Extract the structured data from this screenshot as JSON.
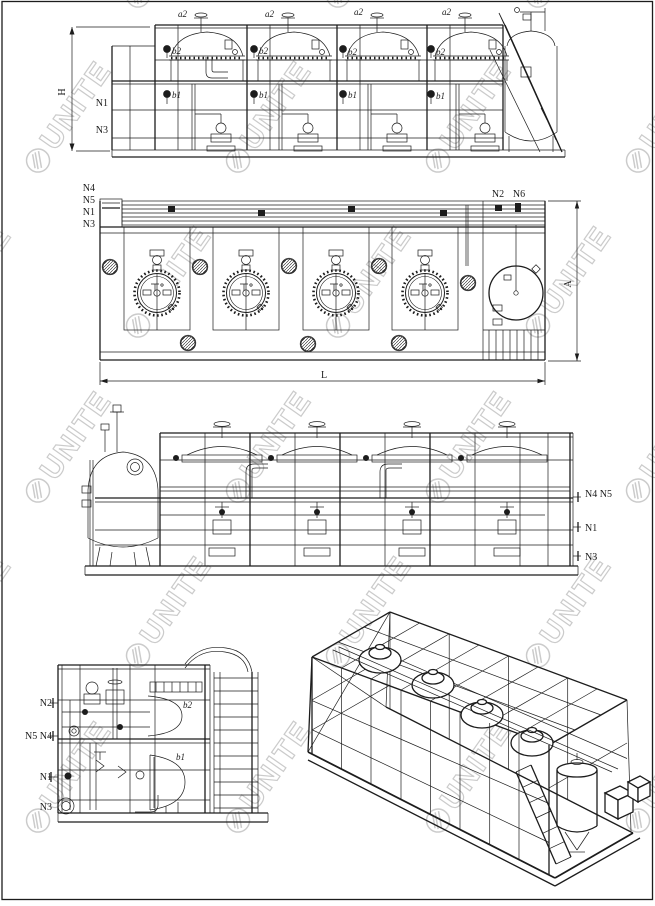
{
  "colors": {
    "ink": "#1c1c1c",
    "paper": "#ffffff",
    "watermark": "#cbcbcb"
  },
  "watermark": {
    "logo": "hatched-circle-icon",
    "text": "UNITE"
  },
  "views": {
    "front_elevation": {
      "dim_height": "H",
      "nozzle_n1": "N1",
      "nozzle_n3": "N3",
      "valve_a2": "a2",
      "valve_b2": "b2",
      "valve_b1": "b1"
    },
    "plan": {
      "nozzle_n4": "N4",
      "nozzle_n5": "N5",
      "nozzle_n1": "N1",
      "nozzle_n3": "N3",
      "nozzle_n2": "N2",
      "nozzle_n6": "N6",
      "dim_length": "L",
      "dim_width": "A"
    },
    "rear_elevation": {
      "nozzle_n4_n5": "N4 N5",
      "nozzle_n1": "N1",
      "nozzle_n3": "N3"
    },
    "end_elevation": {
      "nozzle_n2": "N2",
      "nozzle_n5_n4": "N5 N4",
      "nozzle_n1": "N1",
      "nozzle_n3": "N3",
      "valve_b2": "b2",
      "valve_b1": "b1"
    }
  }
}
